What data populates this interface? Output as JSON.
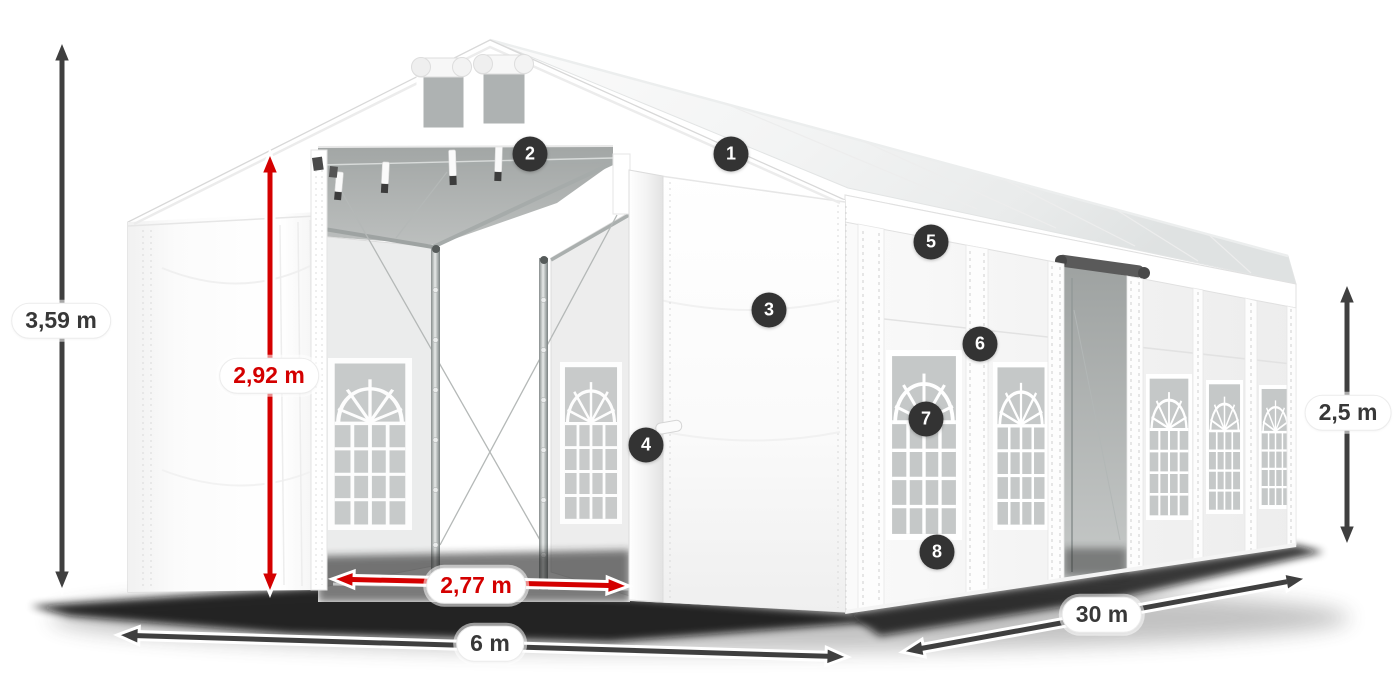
{
  "diagram": {
    "type": "product-dimension-diagram",
    "subject": "White party marquee tent with open front entrance, roof vents and arched side windows",
    "dimensions": {
      "total_height": "3,59 m",
      "entrance_height": "2,92 m",
      "entrance_width": "2,77 m",
      "front_width": "6 m",
      "length": "30 m",
      "side_wall_height": "2,5 m"
    },
    "markers": [
      {
        "number": "1"
      },
      {
        "number": "2"
      },
      {
        "number": "3"
      },
      {
        "number": "4"
      },
      {
        "number": "5"
      },
      {
        "number": "6"
      },
      {
        "number": "7"
      },
      {
        "number": "8"
      }
    ],
    "colors": {
      "dimension_red": "#d40000",
      "dimension_dark": "#3f3f3f",
      "marker_background": "#333333",
      "label_text": "#383838",
      "background": "#ffffff"
    }
  }
}
